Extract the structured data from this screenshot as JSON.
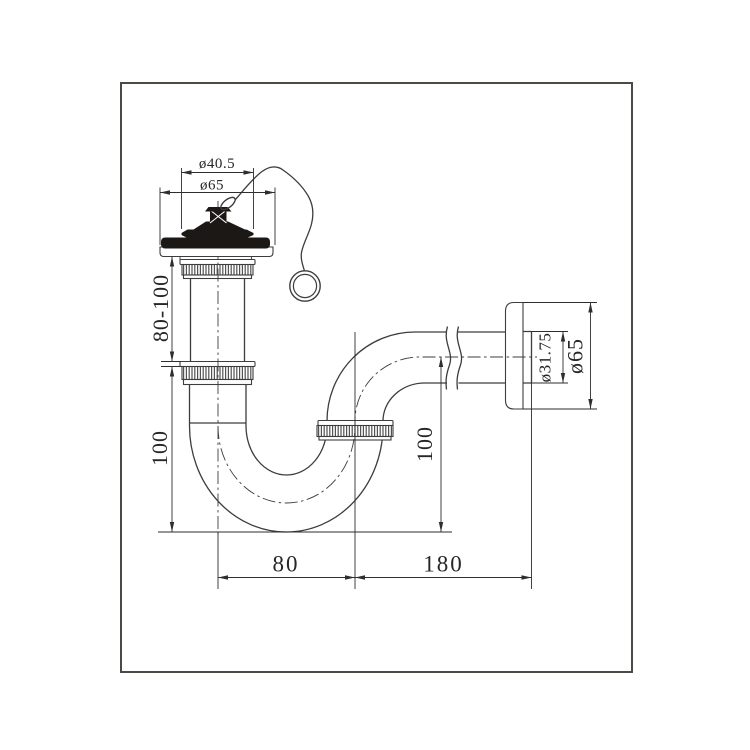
{
  "drawing": {
    "subject": "basin P-trap drain set with plug, chain and wall outlet - technical dimension drawing",
    "style": {
      "background": "#ffffff",
      "line_color": "#3d3d3d",
      "dimension_text_color": "#262626",
      "solid_part_color": "#1c1815",
      "frame_color": "#4d4a46"
    },
    "dimensions": {
      "plug_diameter": "ø40.5",
      "top_flange_diameter": "ø65",
      "tailpiece_length": "80-100",
      "trap_drop_height": "100",
      "trap_width": "80",
      "outlet_run_length": "180",
      "outlet_rise_height": "100",
      "outlet_pipe_diameter": "ø31.75",
      "wall_flange_diameter": "ø65"
    }
  }
}
